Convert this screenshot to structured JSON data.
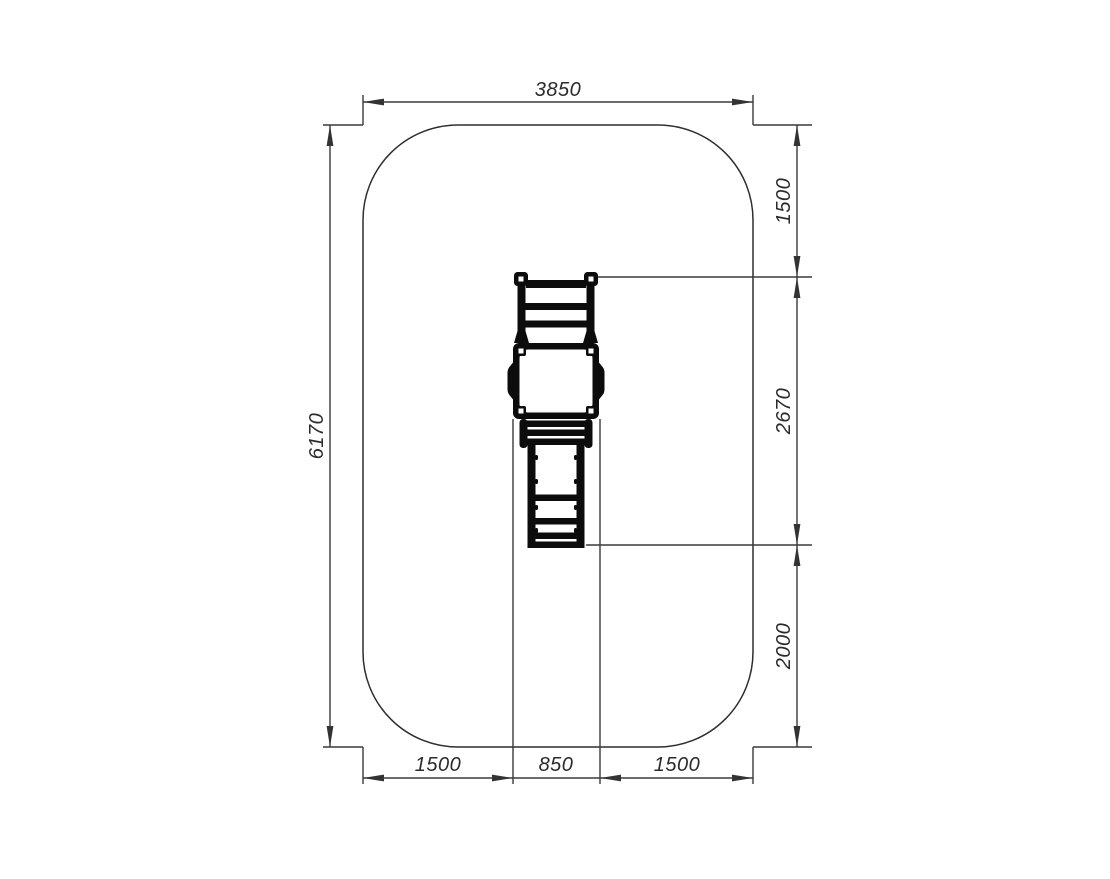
{
  "drawing": {
    "type": "technical-plan-top-view",
    "subject": "playground-slide-safety-zone-plan",
    "background_color": "#ffffff",
    "line_color": "#3a3a3a",
    "equipment_color": "#0c0c0c",
    "dims": {
      "total_width": "3850",
      "total_height": "6170",
      "right_top": "1500",
      "right_middle": "2670",
      "right_bottom": "2000",
      "bottom_left": "1500",
      "bottom_center": "850",
      "bottom_right": "1500"
    }
  }
}
